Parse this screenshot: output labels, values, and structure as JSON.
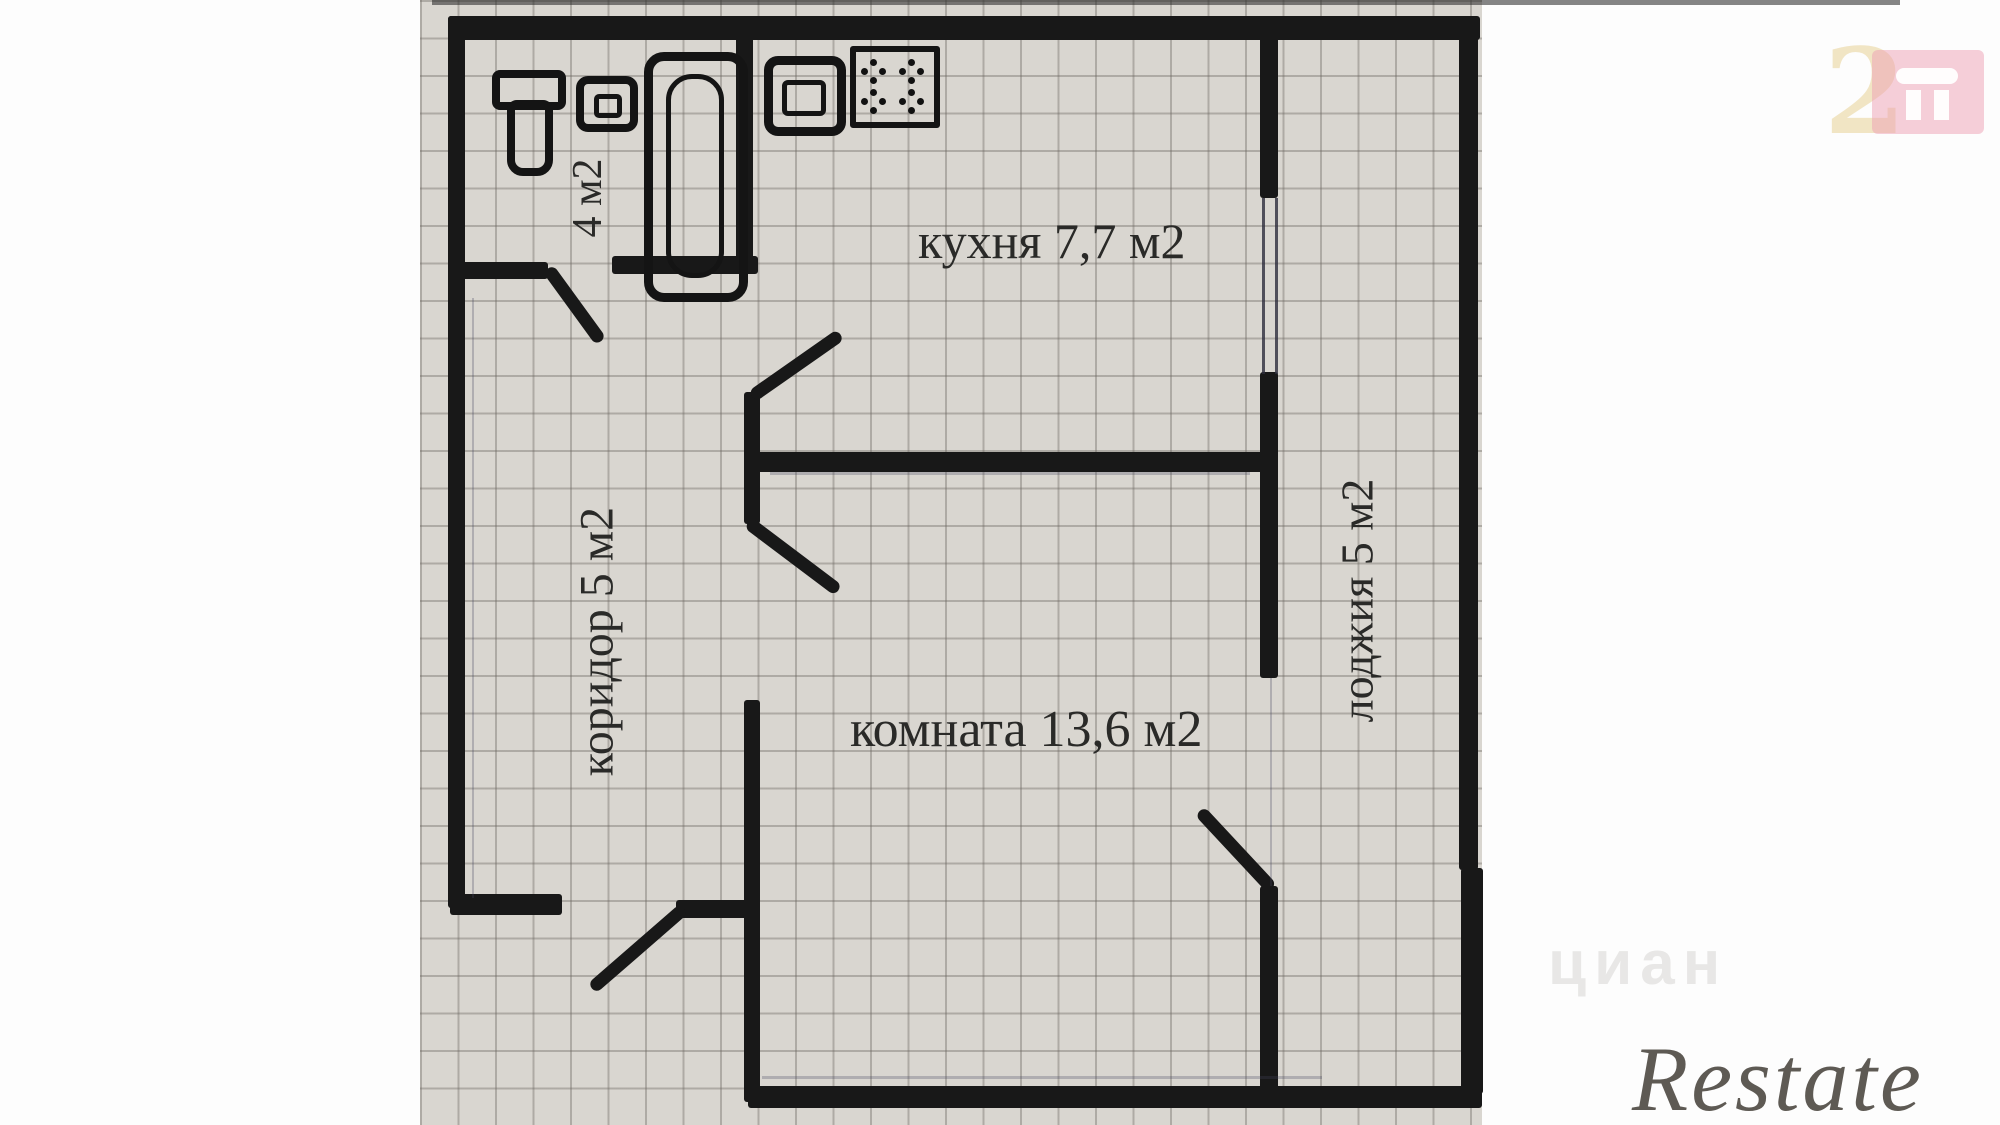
{
  "plan": {
    "type": "apartment-floor-plan",
    "rooms": {
      "kitchen": {
        "name": "кухня",
        "area_m2": "7,7",
        "label": "кухня 7,7 м2"
      },
      "room": {
        "name": "комната",
        "area_m2": "13,6",
        "label": "комната 13,6 м2"
      },
      "corridor": {
        "name": "коридор",
        "area_m2": "5",
        "label": "коридор 5 м2"
      },
      "loggia": {
        "name": "лоджия",
        "area_m2": "5",
        "label": "лоджия 5 м2"
      },
      "bathroom": {
        "name": "санузел",
        "area_m2": "4",
        "label": "4 м2"
      }
    },
    "fixtures": [
      "toilet-icon",
      "wash-basin-icon",
      "bathtub-icon",
      "kitchen-sink-icon",
      "stove-icon"
    ],
    "colors": {
      "wall": "#181818",
      "paper": "#d9d6d0",
      "grid_line": "#69645e",
      "label_text": "#2a2a28"
    }
  },
  "watermarks": {
    "site_logo_digit": "2",
    "site_logo_colors": {
      "digit_cream": "#eee0ba",
      "square_pink": "#ee a0b4",
      "glyph_white": "#ffffff"
    },
    "portal_faint": "циан",
    "agency": "Restate"
  }
}
